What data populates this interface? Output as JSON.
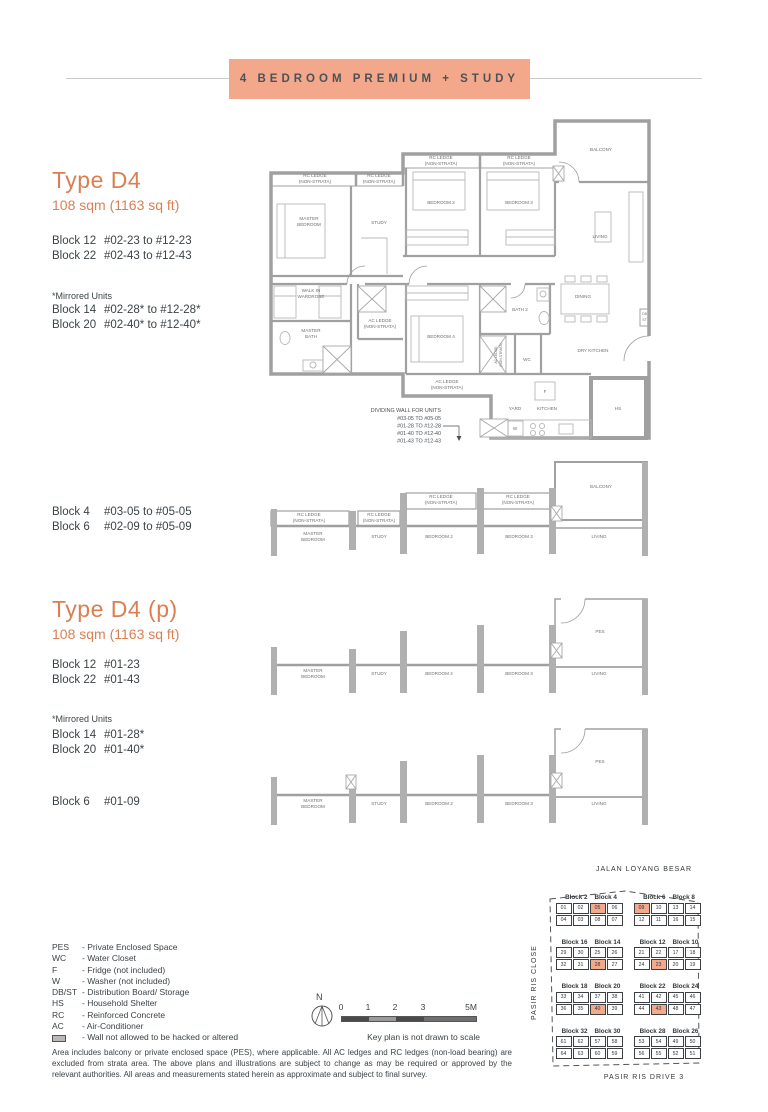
{
  "colors": {
    "banner": "#f4a88b",
    "heading": "#db7f53",
    "keyplan_highlight": "#f2a98c"
  },
  "page": {
    "banner_title": "4 BEDROOM PREMIUM + STUDY"
  },
  "type_d4": {
    "title": "Type D4",
    "area": "108 sqm (1163 sq ft)",
    "blocks": [
      {
        "block": "Block 12",
        "units": "#02-23 to #12-23"
      },
      {
        "block": "Block 22",
        "units": "#02-43 to #12-43"
      }
    ],
    "mirrored_label": "*Mirrored Units",
    "mirrored_blocks": [
      {
        "block": "Block 14",
        "units": "#02-28* to #12-28*"
      },
      {
        "block": "Block 20",
        "units": "#02-40* to #12-40*"
      }
    ],
    "blocks2": [
      {
        "block": "Block 4",
        "units": "#03-05 to #05-05"
      },
      {
        "block": "Block 6",
        "units": "#02-09 to #05-09"
      }
    ]
  },
  "type_d4p": {
    "title": "Type D4 (p)",
    "area": "108 sqm (1163 sq ft)",
    "blocks": [
      {
        "block": "Block 12",
        "units": "#01-23"
      },
      {
        "block": "Block 22",
        "units": "#01-43"
      }
    ],
    "mirrored_label": "*Mirrored Units",
    "mirrored_blocks": [
      {
        "block": "Block 14",
        "units": "#01-28*"
      },
      {
        "block": "Block 20",
        "units": "#01-40*"
      }
    ],
    "blocks2": [
      {
        "block": "Block 6",
        "units": "#01-09"
      }
    ]
  },
  "plan1": {
    "labels": [
      {
        "t": "RC LEDGE",
        "x": 52,
        "y": 71
      },
      {
        "t": "(NON-STRATA)",
        "x": 52,
        "y": 77
      },
      {
        "t": "RC LEDGE",
        "x": 116,
        "y": 71
      },
      {
        "t": "(NON-STRATA)",
        "x": 116,
        "y": 77
      },
      {
        "t": "RC LEDGE",
        "x": 178,
        "y": 53
      },
      {
        "t": "(NON-STRATA)",
        "x": 178,
        "y": 59
      },
      {
        "t": "RC LEDGE",
        "x": 256,
        "y": 53
      },
      {
        "t": "(NON-STRATA)",
        "x": 256,
        "y": 59
      },
      {
        "t": "BALCONY",
        "x": 338,
        "y": 45
      },
      {
        "t": "MASTER",
        "x": 46,
        "y": 114
      },
      {
        "t": "BEDROOM",
        "x": 46,
        "y": 120
      },
      {
        "t": "STUDY",
        "x": 116,
        "y": 118
      },
      {
        "t": "BEDROOM 2",
        "x": 178,
        "y": 98
      },
      {
        "t": "BEDROOM 3",
        "x": 256,
        "y": 98
      },
      {
        "t": "LIVING",
        "x": 337,
        "y": 132
      },
      {
        "t": "WALK IN",
        "x": 48,
        "y": 186
      },
      {
        "t": "WARDROBE",
        "x": 48,
        "y": 192
      },
      {
        "t": "MASTER",
        "x": 48,
        "y": 226
      },
      {
        "t": "BATH",
        "x": 48,
        "y": 232
      },
      {
        "t": "AC LEDGE",
        "x": 117,
        "y": 216
      },
      {
        "t": "(NON-STRATA)",
        "x": 117,
        "y": 222
      },
      {
        "t": "BEDROOM 4",
        "x": 178,
        "y": 232
      },
      {
        "t": "BATH 2",
        "x": 257,
        "y": 205
      },
      {
        "t": "WC",
        "x": 264,
        "y": 255
      },
      {
        "t": "DINING",
        "x": 320,
        "y": 192
      },
      {
        "t": "DRY KITCHEN",
        "x": 330,
        "y": 246
      },
      {
        "t": "AC LEDGE",
        "x": 184,
        "y": 277
      },
      {
        "t": "(NON-STRATA)",
        "x": 184,
        "y": 283
      },
      {
        "t": "YARD",
        "x": 252,
        "y": 304
      },
      {
        "t": "KITCHEN",
        "x": 284,
        "y": 304
      },
      {
        "t": "HS",
        "x": 355,
        "y": 304
      },
      {
        "t": "F",
        "x": 282,
        "y": 287
      },
      {
        "t": "W",
        "x": 252,
        "y": 324
      },
      {
        "t": "DB",
        "x": 381.5,
        "y": 209,
        "s": 3.4
      },
      {
        "t": "ST",
        "x": 381.5,
        "y": 215,
        "s": 3.4
      },
      {
        "t": "AC LEDGE",
        "x": 234,
        "y": 249,
        "s": 3.4,
        "r": -90
      },
      {
        "t": "(NON-STRATA)",
        "x": 239,
        "y": 249,
        "s": 3.4,
        "r": -90
      },
      {
        "t": "DIVIDING WALL FOR UNITS",
        "x": 178,
        "y": 306,
        "s": 5.4,
        "c": "#4a5054",
        "a": "end"
      },
      {
        "t": "#03-05 TO #05-05",
        "x": 178,
        "y": 314,
        "s": 5.4,
        "c": "#4a5054",
        "a": "end"
      },
      {
        "t": "#01-28 TO #12-28",
        "x": 178,
        "y": 321.5,
        "s": 5.4,
        "c": "#4a5054",
        "a": "end"
      },
      {
        "t": "#01-40 TO #12-40",
        "x": 178,
        "y": 329,
        "s": 5.4,
        "c": "#4a5054",
        "a": "end"
      },
      {
        "t": "#01-43 TO #12-43",
        "x": 178,
        "y": 336.5,
        "s": 5.4,
        "c": "#4a5054",
        "a": "end"
      }
    ]
  },
  "plan2": {
    "labels": [
      {
        "t": "RC LEDGE",
        "x": 46,
        "y": 68
      },
      {
        "t": "(NON-STRATA)",
        "x": 46,
        "y": 74
      },
      {
        "t": "RC LEDGE",
        "x": 116,
        "y": 68
      },
      {
        "t": "(NON-STRATA)",
        "x": 116,
        "y": 74
      },
      {
        "t": "RC LEDGE",
        "x": 178,
        "y": 50
      },
      {
        "t": "(NON-STRATA)",
        "x": 178,
        "y": 56
      },
      {
        "t": "RC LEDGE",
        "x": 255,
        "y": 50
      },
      {
        "t": "(NON-STRATA)",
        "x": 255,
        "y": 56
      },
      {
        "t": "BALCONY",
        "x": 338,
        "y": 40
      },
      {
        "t": "MASTER",
        "x": 50,
        "y": 87
      },
      {
        "t": "BEDROOM",
        "x": 50,
        "y": 93
      },
      {
        "t": "STUDY",
        "x": 116,
        "y": 90
      },
      {
        "t": "BEDROOM 2",
        "x": 176,
        "y": 90
      },
      {
        "t": "BEDROOM 3",
        "x": 256,
        "y": 90
      },
      {
        "t": "LIVING",
        "x": 336,
        "y": 90
      }
    ]
  },
  "plan_pes": {
    "labels": [
      {
        "t": "PES",
        "x": 337,
        "y": 46
      },
      {
        "t": "MASTER",
        "x": 50,
        "y": 85
      },
      {
        "t": "BEDROOM",
        "x": 50,
        "y": 91
      },
      {
        "t": "STUDY",
        "x": 116,
        "y": 88
      },
      {
        "t": "BEDROOM 2",
        "x": 176,
        "y": 88
      },
      {
        "t": "BEDROOM 3",
        "x": 256,
        "y": 88
      },
      {
        "t": "LIVING",
        "x": 336,
        "y": 88
      }
    ]
  },
  "legend": {
    "items": [
      {
        "abbr": "PES",
        "desc": "- Private Enclosed Space"
      },
      {
        "abbr": "WC",
        "desc": "- Water Closet"
      },
      {
        "abbr": "F",
        "desc": "- Fridge (not included)"
      },
      {
        "abbr": "W",
        "desc": "- Washer (not included)"
      },
      {
        "abbr": "DB/ST",
        "desc": "- Distribution Board/ Storage"
      },
      {
        "abbr": "HS",
        "desc": "- Household Shelter"
      },
      {
        "abbr": "RC",
        "desc": "- Reinforced Concrete"
      },
      {
        "abbr": "AC",
        "desc": "- Air-Conditioner"
      },
      {
        "abbr": "",
        "wall_icon": true,
        "desc": "- Wall not allowed to be hacked or altered"
      }
    ]
  },
  "scale": {
    "north_label": "N",
    "ticks": [
      "0",
      "1",
      "2",
      "3",
      "5M"
    ],
    "note": "Key plan is not drawn to scale"
  },
  "disclaimer": "Area includes balcony or private enclosed space (PES), where applicable. All AC ledges and RC ledges (non-load bearing) are excluded from strata area. The above plans and illustrations are subject to change as may be required or approved by the relevant authorities. All areas and measurements stated herein as approximate and subject to final survey.",
  "keyplan": {
    "top_road": "JALAN LOYANG BESAR",
    "left_road": "PASIR RIS CLOSE",
    "bottom_road": "PASIR RIS DRIVE 3",
    "clusters": [
      {
        "block_a": "Block 2",
        "block_b": "Block 4",
        "top": [
          "01",
          "02",
          "05",
          "06"
        ],
        "bottom": [
          "04",
          "03",
          "08",
          "07"
        ],
        "highlight": [
          "05"
        ]
      },
      {
        "block_a": "Block 6",
        "block_b": "Block 8",
        "top": [
          "09",
          "10",
          "13",
          "14"
        ],
        "bottom": [
          "12",
          "11",
          "16",
          "15"
        ],
        "highlight": [
          "09"
        ]
      },
      {
        "block_a": "Block 16",
        "block_b": "Block 14",
        "top": [
          "29",
          "30",
          "25",
          "26"
        ],
        "bottom": [
          "32",
          "31",
          "28",
          "27"
        ],
        "highlight": [
          "28"
        ]
      },
      {
        "block_a": "Block 12",
        "block_b": "Block 10",
        "top": [
          "21",
          "22",
          "17",
          "18"
        ],
        "bottom": [
          "24",
          "23",
          "20",
          "19"
        ],
        "highlight": [
          "23"
        ]
      },
      {
        "block_a": "Block 18",
        "block_b": "Block 20",
        "top": [
          "33",
          "34",
          "37",
          "38"
        ],
        "bottom": [
          "36",
          "35",
          "40",
          "39"
        ],
        "highlight": [
          "40"
        ]
      },
      {
        "block_a": "Block 22",
        "block_b": "Block 24",
        "top": [
          "41",
          "42",
          "45",
          "46"
        ],
        "bottom": [
          "44",
          "43",
          "48",
          "47"
        ],
        "highlight": [
          "43"
        ]
      },
      {
        "block_a": "Block 32",
        "block_b": "Block 30",
        "top": [
          "61",
          "62",
          "57",
          "58"
        ],
        "bottom": [
          "64",
          "63",
          "60",
          "59"
        ],
        "highlight": []
      },
      {
        "block_a": "Block 28",
        "block_b": "Block 26",
        "top": [
          "53",
          "54",
          "49",
          "50"
        ],
        "bottom": [
          "56",
          "55",
          "52",
          "51"
        ],
        "highlight": []
      }
    ]
  }
}
